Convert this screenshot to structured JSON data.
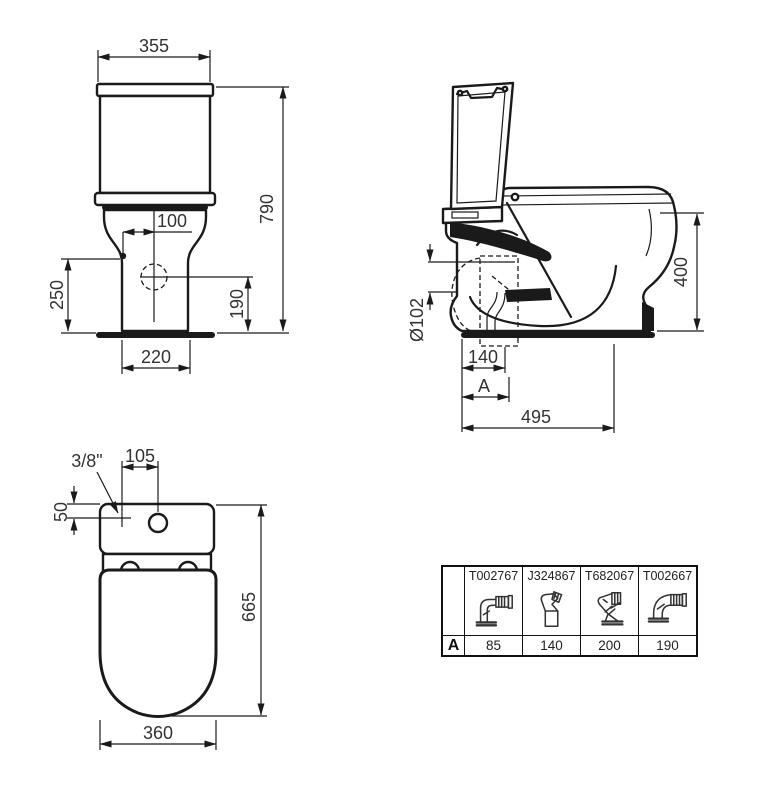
{
  "colors": {
    "background": "#ffffff",
    "line_color": "#1a1a1a",
    "text_color": "#333333"
  },
  "front_view": {
    "tank_width": "355",
    "total_height": "790",
    "inlet_offset": "100",
    "side_height": "250",
    "outlet_height": "190",
    "base_width": "220"
  },
  "side_view": {
    "outlet_diameter": "Ø102",
    "outlet_setout": "140",
    "variable_setout_label": "A",
    "total_depth": "495",
    "bowl_height": "400"
  },
  "top_view": {
    "water_inlet": "3/8\"",
    "button_offset": "105",
    "inlet_setback": "50",
    "total_length": "665",
    "bowl_width": "360"
  },
  "connector_table": {
    "row_header": "A",
    "columns": [
      {
        "part": "T002767",
        "value": "85",
        "icon": "elbow-corrugated-connector-icon"
      },
      {
        "part": "J324867",
        "value": "140",
        "icon": "offset-bend-connector-icon"
      },
      {
        "part": "T682067",
        "value": "200",
        "icon": "angled-connector-icon"
      },
      {
        "part": "T002667",
        "value": "190",
        "icon": "elbow-corrugated-up-connector-icon"
      }
    ]
  }
}
